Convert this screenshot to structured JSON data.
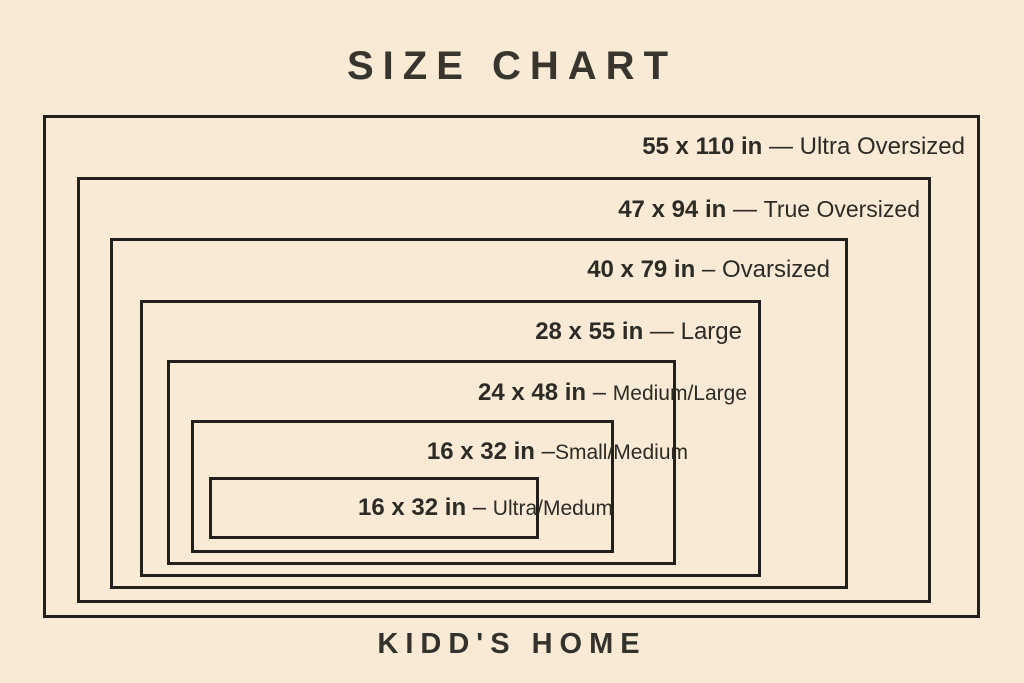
{
  "title": "SIZE CHART",
  "brand": "KIDD'S HOME",
  "colors": {
    "background": "#f8ead4",
    "line": "#21201c",
    "text": "#2c2b26"
  },
  "sizes": [
    {
      "size": "55 x 110 in",
      "sep": " — ",
      "name": "Ultra Oversized"
    },
    {
      "size": "47 x 94 in",
      "sep": " — ",
      "name": "True Oversized"
    },
    {
      "size": "40 x 79 in",
      "sep": " – ",
      "name": "Ovarsized"
    },
    {
      "size": "28 x 55 in",
      "sep": " — ",
      "name": "Large"
    },
    {
      "size": "24 x 48 in",
      "sep": " – ",
      "name": "Medium/Large"
    },
    {
      "size": "16 x 32 in",
      "sep": " –",
      "name": "Small/Medium"
    },
    {
      "size": "16 x 32 in",
      "sep": " – ",
      "name": "Ultra/Medum"
    }
  ]
}
